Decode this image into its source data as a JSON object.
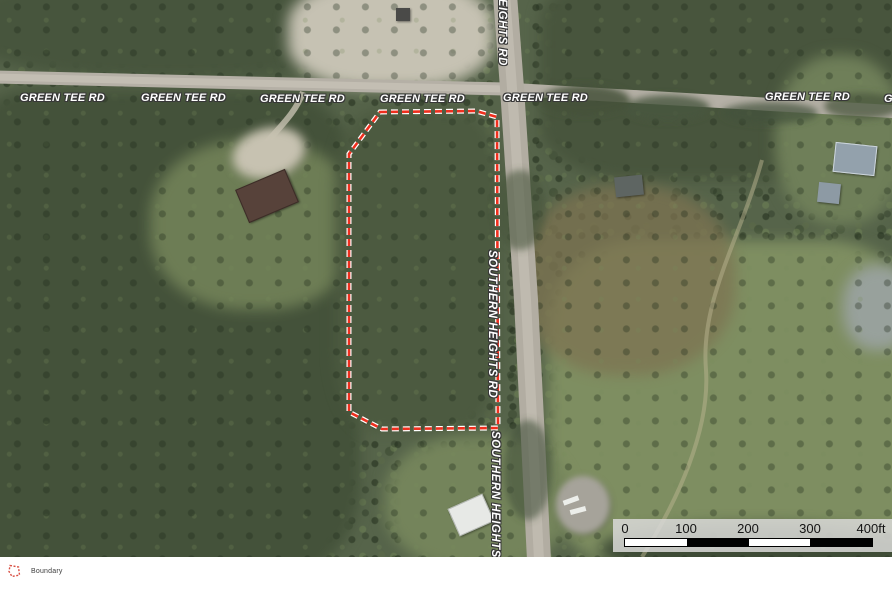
{
  "map": {
    "road_labels": {
      "green_tee": {
        "text": "GREEN TEE RD"
      },
      "heights_top": {
        "text": "HEIGHTS RD"
      },
      "southern_heights": {
        "text": "SOUTHERN HEIGHTS RD"
      }
    },
    "boundary": {
      "points": "380,112 476,111 497,117 498,428 382,429 349,412 349,154",
      "color": "#ef2f1e",
      "casing_color": "#ffffff"
    },
    "scalebar": {
      "ticks": [
        "0",
        "100",
        "200",
        "300"
      ],
      "end_label": "400ft",
      "segment_colors": [
        "#ffffff",
        "#000000",
        "#ffffff",
        "#000000"
      ]
    }
  },
  "legend": {
    "boundary_label": "Boundary",
    "swatch_color": "#d94f43"
  }
}
